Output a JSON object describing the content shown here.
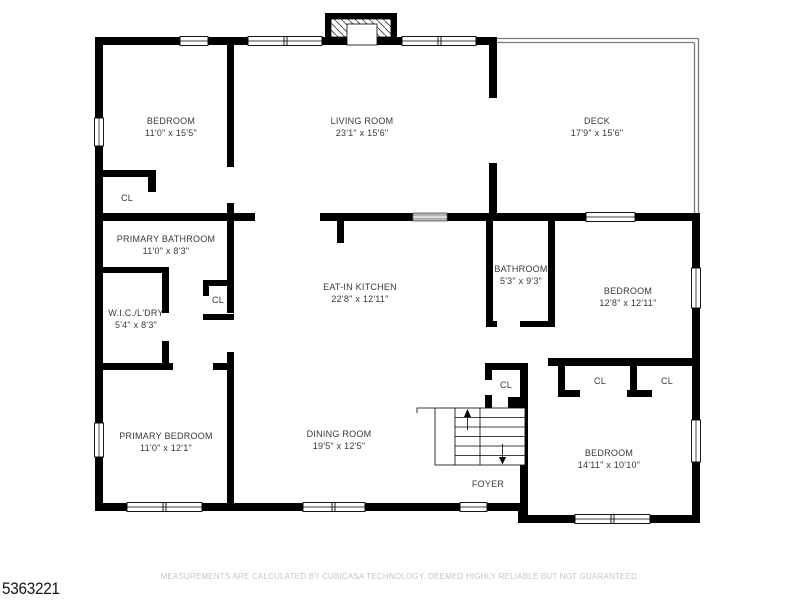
{
  "plan_id": "5363221",
  "disclaimer": "MEASUREMENTS ARE CALCULATED BY CUBICASA TECHNOLOGY. DEEMED HIGHLY RELIABLE BUT NOT GUARANTEED.",
  "colors": {
    "walls": "#000000",
    "room_label_text": "#383838",
    "disclaimer_text": "#c5c5c5",
    "sliding_door_fill": "#b5b5b5",
    "deck_outline": "#7a7a7a",
    "background": "#ffffff"
  },
  "rooms": [
    {
      "name": "BEDROOM",
      "dims": "11'0\" x 15'5\""
    },
    {
      "name": "LIVING ROOM",
      "dims": "23'1\" x 15'6\""
    },
    {
      "name": "DECK",
      "dims": "17'9\" x 15'6\""
    },
    {
      "name": "PRIMARY BATHROOM",
      "dims": "11'0\" x 8'3\""
    },
    {
      "name": "W.I.C./L'DRY",
      "dims": "5'4\" x 8'3\""
    },
    {
      "name": "EAT-IN KITCHEN",
      "dims": "22'8\" x 12'11\""
    },
    {
      "name": "BATHROOM",
      "dims": "5'3\" x 9'3\""
    },
    {
      "name": "BEDROOM",
      "dims": "12'8\" x 12'11\""
    },
    {
      "name": "PRIMARY BEDROOM",
      "dims": "11'0\" x 12'1\""
    },
    {
      "name": "DINING ROOM",
      "dims": "19'5\" x 12'5\""
    },
    {
      "name": "BEDROOM",
      "dims": "14'11\" x 10'10\""
    },
    {
      "name": "FOYER",
      "dims": ""
    }
  ],
  "closets": [
    {
      "label": "CL"
    },
    {
      "label": "CL"
    },
    {
      "label": "CL"
    },
    {
      "label": "CL"
    },
    {
      "label": "CL"
    }
  ]
}
